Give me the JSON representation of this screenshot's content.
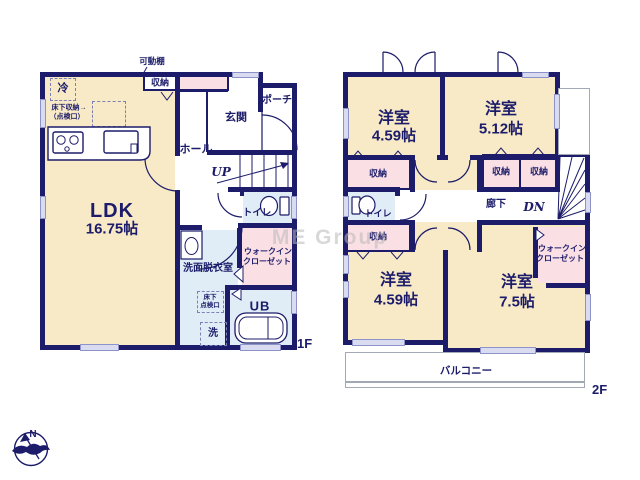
{
  "watermark": "ME Group",
  "compass": {
    "north": "N"
  },
  "f1": {
    "floor_label": "1F",
    "movable_shelf": "可動棚",
    "storage": "収納",
    "fridge": "冷",
    "underfloor_note_1": "床下収納→",
    "underfloor_note_2": "（点検口）",
    "ldk_name": "LDK",
    "ldk_size": "16.75帖",
    "entrance": "玄関",
    "porch": "ポーチ",
    "hall": "ホール",
    "stairs_up": "UP",
    "toilet": "トイレ",
    "wic_line1": "ウォークイン",
    "wic_line2": "クローゼット",
    "washroom": "洗面脱衣室",
    "hatch_line1": "床下",
    "hatch_line2": "点検口",
    "bath": "UB",
    "laundry": "洗"
  },
  "f2": {
    "floor_label": "2F",
    "room_nw_name": "洋室",
    "room_nw_size": "4.59帖",
    "room_ne_name": "洋室",
    "room_ne_size": "5.12帖",
    "room_sw_name": "洋室",
    "room_sw_size": "4.59帖",
    "room_se_name": "洋室",
    "room_se_size": "7.5帖",
    "storage": "収納",
    "toilet": "トイレ",
    "corridor": "廊下",
    "stairs_dn": "DN",
    "wic_line1": "ウォークイン",
    "wic_line2": "クローゼット",
    "balcony": "バルコニー"
  },
  "colors": {
    "wall": "#1c1c6a",
    "room_cream": "#f8eac7",
    "wet_blue": "#e0edf6",
    "closet_pink": "#fadfe4",
    "window_lavender": "#d9dcf0"
  }
}
